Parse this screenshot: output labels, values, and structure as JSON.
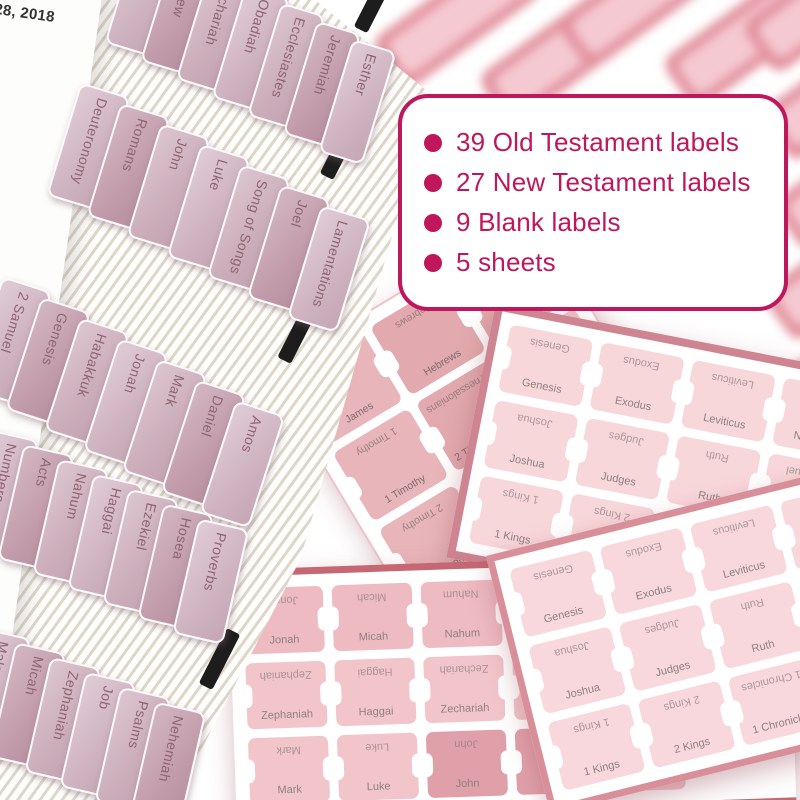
{
  "callout": {
    "items": [
      "39 Old Testament labels",
      "27 New Testament labels",
      "9 Blank labels",
      "5 sheets"
    ]
  },
  "book": {
    "page": {
      "date_fragment": "ust 28, 2018",
      "lines": [
        "d diam",
        "magna",
        "ostrud",
        "com-",
        "rit in",
        "giat",
        "qui",
        "ait"
      ]
    },
    "tab_rows": [
      [
        "Titus",
        "Matthew",
        "Zechariah",
        "Obadiah",
        "Ecclesiastes",
        "Jeremiah",
        "Esther"
      ],
      [
        "Deuteronomy",
        "Romans",
        "John",
        "Luke",
        "Song of Songs",
        "Joel",
        "Lamentations"
      ],
      [
        "2 Samuel",
        "Genesis",
        "Habakkuk",
        "Jonah",
        "Mark",
        "Daniel",
        "Amos"
      ],
      [
        "Numbers",
        "Acts",
        "Nahum",
        "Haggai",
        "Ezekiel",
        "Hosea",
        "Proverbs"
      ],
      [
        "Malachi",
        "Micah",
        "Zephaniah",
        "Job",
        "Psalms",
        "Nehemiah"
      ]
    ]
  },
  "sheets": {
    "new_testament": {
      "labels": [
        "James",
        "Hebrews",
        "Philemon",
        "1 Timothy",
        "2 Thessalonians",
        "1 Thessalonians",
        "2 Timothy",
        "Ephesians",
        "Galatians",
        "Philippians",
        "",
        ""
      ]
    },
    "old_testament_upper": {
      "labels": [
        "Genesis",
        "Exodus",
        "Leviticus",
        "Numbers",
        "Joshua",
        "Judges",
        "Ruth",
        "1 Samuel",
        "1 Kings",
        "2 Kings",
        "1 Chronicles",
        "2 Chronicles"
      ]
    },
    "minor_prophets_gospels": {
      "labels": [
        "Jonah",
        "Micah",
        "Nahum",
        "Habakkuk",
        "",
        "Zephaniah",
        "Haggai",
        "Zechariah",
        "Malachi",
        "",
        "Mark",
        "Luke",
        "John",
        "Acts",
        "Romans"
      ]
    },
    "old_testament_lower": {
      "labels": [
        "Genesis",
        "Exodus",
        "Leviticus",
        "Numbers",
        "Deuteronomy",
        "Joshua",
        "Judges",
        "Ruth",
        "1 Samuel",
        "2 Samuel",
        "1 Kings",
        "2 Kings",
        "1 Chronicles",
        "2 Chronicles"
      ]
    }
  },
  "colors": {
    "accent": "#c0175c",
    "tab_mauve": "#d2b4c1",
    "tab_text_rosegold": "#8f6472",
    "label_pink_light": "#f8d6da",
    "label_pink_dark": "#e2aaae",
    "sheet_border_rose": "#cf8591",
    "page_cream": "#efe9dd"
  }
}
